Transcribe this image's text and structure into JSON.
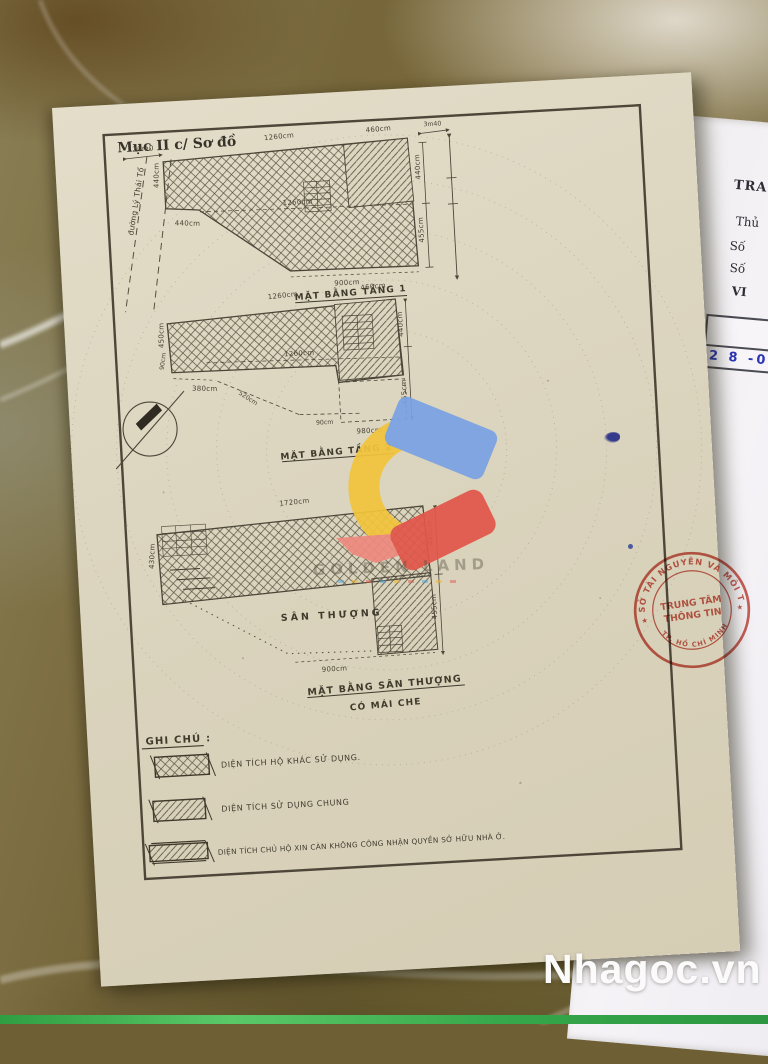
{
  "doc": {
    "section_title": "Mục II c/ Sơ đồ",
    "street_label": "đường Lý Thái Tổ",
    "plan1": {
      "caption": "MẶT BẰNG TẦNG 1",
      "dim_street": "20m0",
      "dim_top": "1260cm",
      "dim_top_right": "460cm",
      "dim_offset": "3m40",
      "dim_left": "440cm",
      "dim_left_bottom": "440cm",
      "dim_inner": "1260cm",
      "dim_right_upper": "440cm",
      "dim_right_lower": "455cm",
      "dim_bottom": "900cm"
    },
    "plan2": {
      "caption": "MẶT BẰNG TẦNG 2",
      "dim_top": "1260cm",
      "dim_top_right": "460cm",
      "dim_left": "450cm",
      "dim_left_small": "90cm",
      "dim_bottom_left": "380cm",
      "dim_diagonal": "520cm",
      "dim_inner": "1260cm",
      "dim_bottom_small": "90cm",
      "dim_bottom": "980cm",
      "dim_right_upper": "440cm",
      "dim_right_lower": "455cm"
    },
    "plan3": {
      "caption_line1": "MẶT BẰNG SÂN THƯỢNG",
      "caption_line2": "CÓ MÁI CHE",
      "area_label": "SÂN THƯỢNG",
      "dim_top": "1720cm",
      "dim_left": "430cm",
      "dim_right_upper": "440cm",
      "dim_right_lower": "455cm",
      "dim_bottom": "900cm"
    },
    "legend": {
      "title": "GHI CHÚ :",
      "items": [
        {
          "pattern": "crosshatch",
          "label": "DIỆN TÍCH HỘ KHÁC SỬ DỤNG."
        },
        {
          "pattern": "diagonal",
          "label": "DIỆN TÍCH SỬ DỤNG CHUNG"
        },
        {
          "pattern": "diagonal-ticks",
          "label": "DIỆN TÍCH CHỦ HỘ XIN CÀN KHÔNG CÔNG NHẬN QUYỀN SỞ HỮU NHÀ Ở."
        }
      ]
    }
  },
  "right_page": {
    "line1": "TRA",
    "line2": "Thủ",
    "line3": "Số",
    "line4": "Số",
    "line5": "VI",
    "table": {
      "header_line1": "Ngày, t",
      "header_line2": "nă",
      "date_value": "2 8 -07"
    }
  },
  "stamp": {
    "arc_top": "SỞ TÀI NGUYÊN VÀ MÔI TRƯỜNG",
    "arc_bottom": "TP. HỒ CHÍ MINH",
    "center_line1": "TRUNG TÂM",
    "center_line2": "THÔNG TIN",
    "star": "★"
  },
  "watermark": {
    "brand": "Nhagoc.vn",
    "logo_text": "GOLDEN LAND"
  },
  "colors": {
    "paper": "#dcd5bf",
    "ink": "#4a4336",
    "stamp_red": "#c23b2e",
    "date_blue": "#2b35b5",
    "logo_blue": "#7aa2e4",
    "logo_yellow": "#f2c43c",
    "logo_red": "#e2574a",
    "footer_green": "#37a84b"
  }
}
